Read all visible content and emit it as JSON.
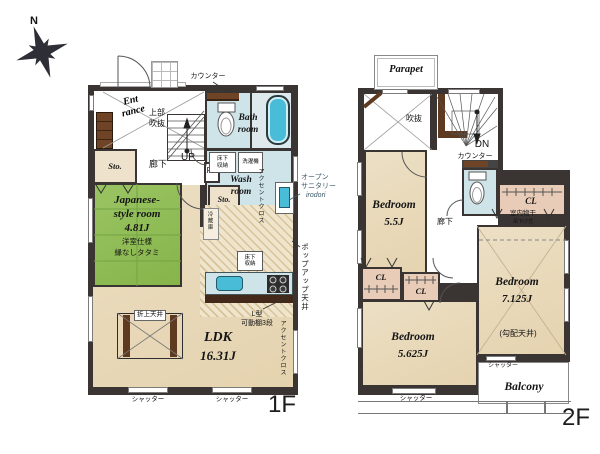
{
  "compass": {
    "north": "N"
  },
  "colors": {
    "wall": "#3a3432",
    "floor_beige": "#e9dabb",
    "tatami_green": "#90bf55",
    "water_blue": "#cfe4e9",
    "fixture_blue": "#49bcd8",
    "closet_pink": "#e9ccb8",
    "wood_brown": "#6e4326"
  },
  "f1": {
    "floor_label": "1F",
    "entrance_l1": "Ent",
    "entrance_l2": "rance",
    "entrance_void_l1": "上部",
    "entrance_void_l2": "吹抜",
    "counter": "カウンター",
    "bath_l1": "Bath",
    "bath_l2": "room",
    "wash_l1": "Wash",
    "wash_l2": "room",
    "underfloor_storage_a_l1": "床下",
    "underfloor_storage_a_l2": "収納",
    "washing_machine": "洗濯機",
    "storage_a": "Sto.",
    "storage_b": "Sto.",
    "corridor": "廊下",
    "up": "UP",
    "ps": "PS",
    "accent_cloth_wash": "アクセントクロス",
    "open_sanitary_l1": "オープン",
    "open_sanitary_l2": "サニタリー",
    "open_sanitary_l3": "irodori",
    "jp_room_l1": "Japanese-",
    "jp_room_l2": "style room",
    "jp_room_size": "4.81J",
    "jp_room_note1": "洋室仕様",
    "jp_room_note2": "縁なしタタミ",
    "refrigerator": "冷蔵庫",
    "underfloor_storage_b_l1": "床下",
    "underfloor_storage_b_l2": "収納",
    "popup_ceiling": "ポップアップ天井",
    "l_shelf_l1": "L型",
    "l_shelf_l2": "可動棚3段",
    "accent_cloth_ldk": "アクセントクロス",
    "coffered_ceiling": "折上天井",
    "ldk_name": "LDK",
    "ldk_size": "16.31J",
    "shutter_a": "シャッター",
    "shutter_b": "シャッター"
  },
  "f2": {
    "floor_label": "2F",
    "parapet": "Parapet",
    "void": "吹抜",
    "dn": "DN",
    "counter": "カウンター",
    "corridor": "廊下",
    "bedroom1_name": "Bedroom",
    "bedroom1_size": "5.5J",
    "cl_a": "CL",
    "cl_b": "CL",
    "cl_c": "CL",
    "indoor_drying_l1": "室内物干",
    "indoor_drying_l2": "吊下げ式",
    "bedroom2_name": "Bedroom",
    "bedroom2_size": "5.625J",
    "bedroom3_name": "Bedroom",
    "bedroom3_size": "7.125J",
    "bedroom3_note": "(勾配天井)",
    "balcony": "Balcony",
    "shutter_a": "シャッター",
    "shutter_b": "シャッター"
  }
}
